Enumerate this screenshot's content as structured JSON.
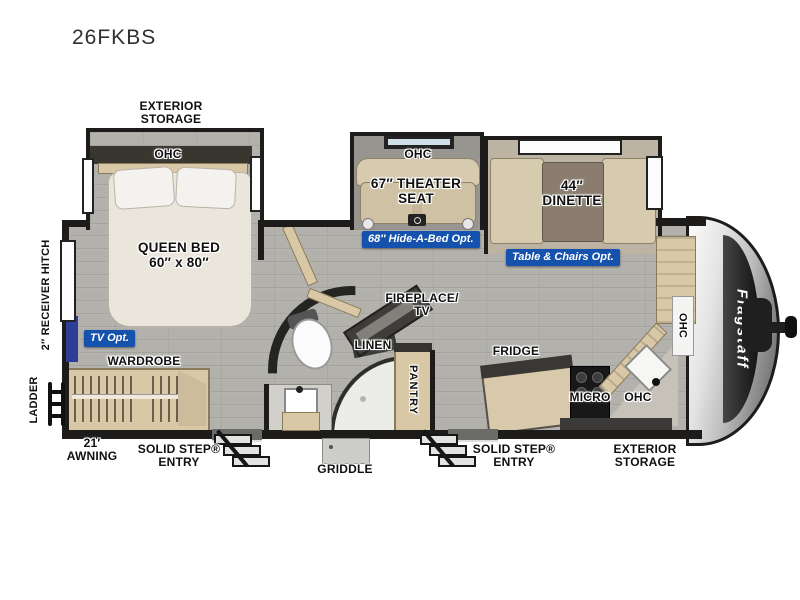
{
  "title": "26FKBS",
  "colors": {
    "badge_blue": "#1552ad",
    "wall": "#1d1c1a",
    "tv_accent_blue": "#2e3d96"
  },
  "badges": {
    "tv": "TV Opt.",
    "hide_a_bed": "68″ Hide-A-Bed Opt.",
    "table_chairs": "Table & Chairs Opt."
  },
  "labels": {
    "exterior_storage1": "EXTERIOR",
    "exterior_storage2": "STORAGE",
    "ohc": "OHC",
    "queen1": "QUEEN BED",
    "queen2": "60″ x 80″",
    "wardrobe": "WARDROBE",
    "theater1": "67″ THEATER",
    "theater2": "SEAT",
    "dinette1": "44″",
    "dinette2": "DINETTE",
    "fireplace1": "FIREPLACE/",
    "fireplace2": "TV",
    "linen": "LINEN",
    "pantry": "PANTRY",
    "fridge": "FRIDGE",
    "micro": "MICRO",
    "receiver_hitch": "2″ RECEIVER HITCH",
    "ladder": "LADDER",
    "awning1": "21′",
    "awning2": "AWNING",
    "entry1": "SOLID STEP®",
    "entry2": "ENTRY",
    "griddle": "GRIDDLE",
    "brand": "Flagstaff"
  }
}
